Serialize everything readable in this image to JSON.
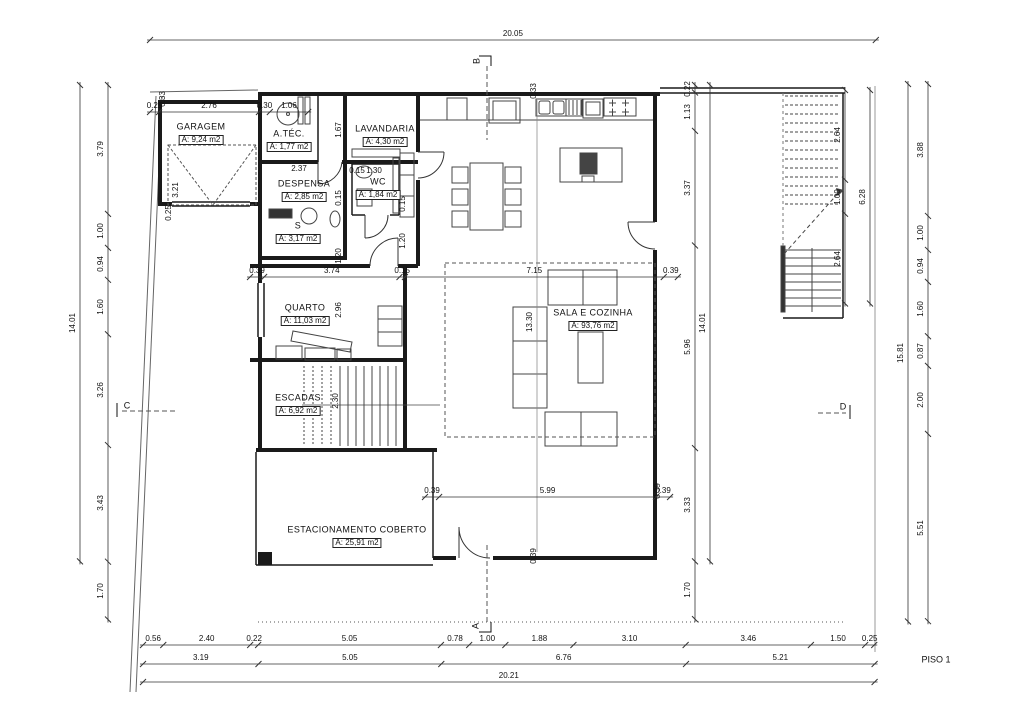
{
  "drawing": {
    "title": "PISO 1"
  },
  "scale": {
    "h": 36.2,
    "v": 34.0
  },
  "rooms": [
    {
      "name": "GARAGEM",
      "area": "A: 9,24 m2",
      "x": 201,
      "y": 127
    },
    {
      "name": "A.TÉC.",
      "area": "A: 1,77 m2",
      "x": 289,
      "y": 134
    },
    {
      "name": "LAVANDARIA",
      "area": "A: 4,30 m2",
      "x": 385,
      "y": 129
    },
    {
      "name": "DESPENSA",
      "area": "A: 2,85 m2",
      "x": 304,
      "y": 184
    },
    {
      "name": "WC",
      "area": "A: 1,84 m2",
      "x": 378,
      "y": 182
    },
    {
      "name": "S",
      "area": "A: 3,17 m2",
      "x": 298,
      "y": 226
    },
    {
      "name": "QUARTO",
      "area": "A: 11,03 m2",
      "x": 305,
      "y": 308
    },
    {
      "name": "ESCADAS",
      "area": "A: 6,92 m2",
      "x": 298,
      "y": 398
    },
    {
      "name": "SALA E COZINHA",
      "area": "A: 93,76 m2",
      "x": 593,
      "y": 313
    },
    {
      "name": "ESTACIONAMENTO COBERTO",
      "area": "A: 25,91 m2",
      "x": 357,
      "y": 530
    }
  ],
  "chains": [
    {
      "id": "top-overall",
      "o": "h",
      "x": 150,
      "y": 40,
      "vals": [
        "20.05"
      ]
    },
    {
      "id": "garage-top",
      "o": "h",
      "x": 150,
      "y": 112,
      "vals": [
        "0.25",
        "2.76",
        "0.30",
        "1.06"
      ]
    },
    {
      "id": "mid-horizontal",
      "o": "h",
      "x": 250,
      "y": 277,
      "vals": [
        "0.39",
        "3.74",
        "0.15",
        "7.15",
        "0.39"
      ]
    },
    {
      "id": "lower-horizontal",
      "o": "h",
      "x": 425,
      "y": 497,
      "vals": [
        "0.39",
        "5.99",
        "0.39"
      ]
    },
    {
      "id": "bottom-row1",
      "o": "h",
      "x": 143,
      "y": 645,
      "vals": [
        "0.56",
        "2.40",
        "0.22",
        "5.05",
        "0.78",
        "1.00",
        "1.88",
        "3.10",
        "3.46",
        "1.50",
        "0.25"
      ]
    },
    {
      "id": "bottom-row2",
      "o": "h",
      "x": 143,
      "y": 664,
      "vals": [
        "3.19",
        "5.05",
        "6.76",
        "5.21"
      ]
    },
    {
      "id": "bottom-overall",
      "o": "h",
      "x": 143,
      "y": 682,
      "vals": [
        "20.21"
      ]
    },
    {
      "id": "left-segments",
      "o": "v",
      "x": 108,
      "y": 85,
      "vals": [
        "3.79",
        "1.00",
        "0.94",
        "1.60",
        "3.26",
        "3.43",
        "1.70"
      ]
    },
    {
      "id": "left-overall",
      "o": "v",
      "x": 80,
      "y": 85,
      "vals": [
        "14.01"
      ]
    },
    {
      "id": "right-segments",
      "o": "v",
      "x": 928,
      "y": 84,
      "vals": [
        "3.88",
        "1.00",
        "0.94",
        "1.60",
        "0.87",
        "2.00",
        "5.51"
      ]
    },
    {
      "id": "right-overall",
      "o": "v",
      "x": 908,
      "y": 84,
      "vals": [
        "15.81"
      ]
    },
    {
      "id": "terrace-segments",
      "o": "v",
      "x": 845,
      "y": 90,
      "vals": [
        "2.64",
        "1.00",
        "2.64"
      ]
    },
    {
      "id": "terrace-overall",
      "o": "v",
      "x": 870,
      "y": 90,
      "vals": [
        "6.28"
      ]
    },
    {
      "id": "inner-right-segments",
      "o": "v",
      "x": 695,
      "y": 85,
      "vals": [
        "0.22",
        "1.13",
        "3.37",
        "5.96",
        "3.33",
        "1.70"
      ]
    },
    {
      "id": "inner-right-overall",
      "o": "v",
      "x": 710,
      "y": 85,
      "vals": [
        "14.01"
      ]
    }
  ],
  "free_dims": [
    {
      "t": "0.33",
      "x": 163,
      "y": 99,
      "o": "v"
    },
    {
      "t": "3.21",
      "x": 176,
      "y": 190,
      "o": "v"
    },
    {
      "t": "0.25",
      "x": 169,
      "y": 213,
      "o": "v"
    },
    {
      "t": "0.33",
      "x": 534,
      "y": 91,
      "o": "v"
    },
    {
      "t": "1.67",
      "x": 339,
      "y": 130,
      "o": "v"
    },
    {
      "t": "0.15",
      "x": 339,
      "y": 198,
      "o": "v"
    },
    {
      "t": "1.20",
      "x": 339,
      "y": 256,
      "o": "v"
    },
    {
      "t": "0.15",
      "x": 403,
      "y": 204,
      "o": "v"
    },
    {
      "t": "1.20",
      "x": 403,
      "y": 241,
      "o": "v"
    },
    {
      "t": "2.96",
      "x": 339,
      "y": 310,
      "o": "v"
    },
    {
      "t": "2.30",
      "x": 336,
      "y": 401,
      "o": "v"
    },
    {
      "t": "13.30",
      "x": 530,
      "y": 322,
      "o": "v"
    },
    {
      "t": "0.39",
      "x": 658,
      "y": 491,
      "o": "v"
    },
    {
      "t": "0.39",
      "x": 534,
      "y": 556,
      "o": "v"
    },
    {
      "t": "2.37",
      "x": 299,
      "y": 169,
      "o": "h"
    },
    {
      "t": "0.15",
      "x": 357,
      "y": 171,
      "o": "h"
    },
    {
      "t": "1.30",
      "x": 374,
      "y": 171,
      "o": "h"
    }
  ],
  "section_markers": [
    {
      "t": "B",
      "x": 477,
      "y": 61,
      "o": "v"
    },
    {
      "t": "A",
      "x": 476,
      "y": 626,
      "o": "v"
    },
    {
      "t": "C",
      "x": 127,
      "y": 406,
      "o": "h"
    },
    {
      "t": "D",
      "x": 843,
      "y": 407,
      "o": "h"
    }
  ]
}
